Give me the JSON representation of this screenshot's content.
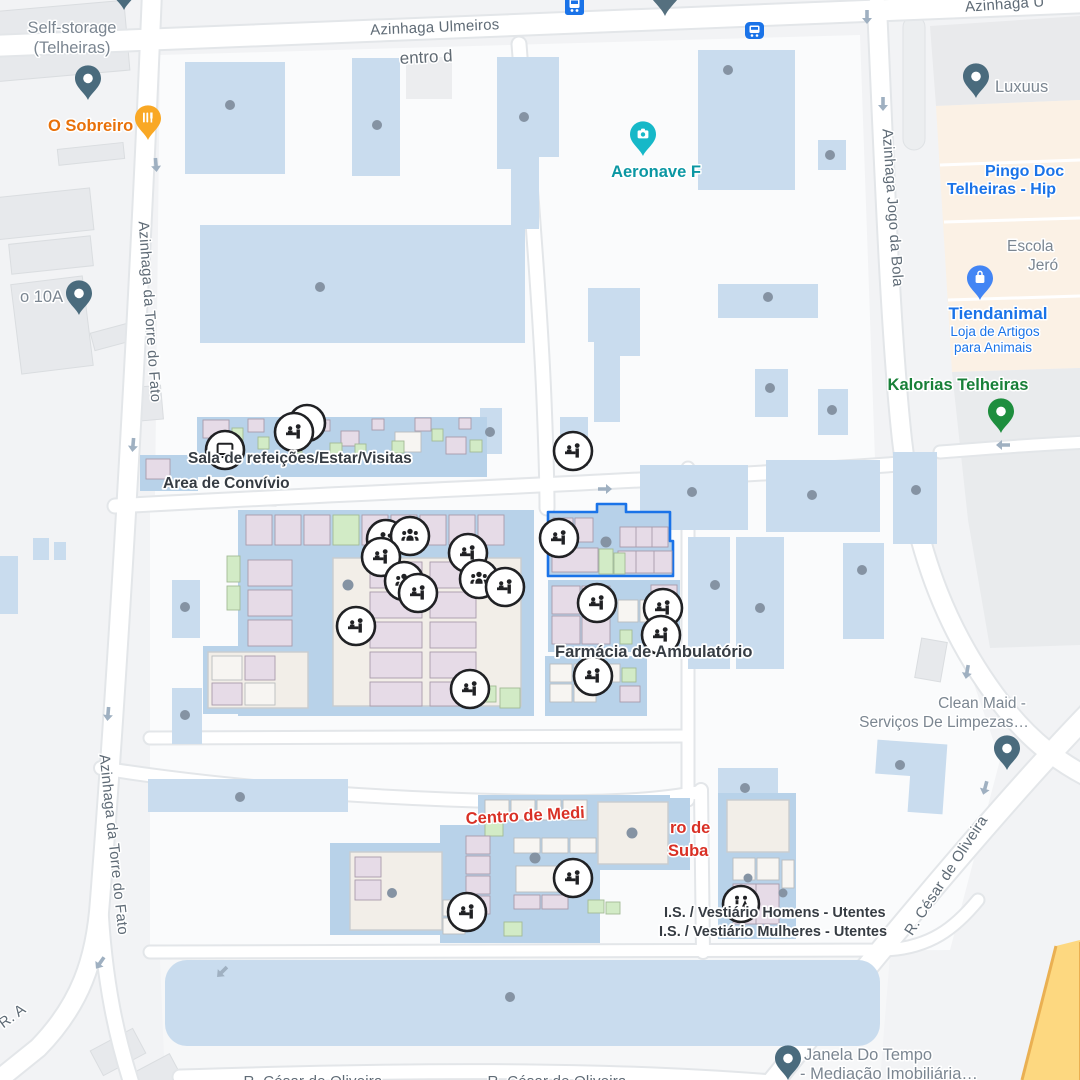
{
  "streets": {
    "ulmeiros": "Azinhaga Ulmeiros",
    "torre": "Azinhaga da Torre do Fato",
    "jogo": "Azinhaga Jogo da Bola",
    "cesar": "R. César de Oliveira",
    "ra": "R. A",
    "top_right_partial": "Azinhaga U",
    "centro_partial": "entro d"
  },
  "pois": {
    "self_storage": {
      "line1": "Self-storage",
      "line2": "(Telheiras)"
    },
    "o_sobreiro": {
      "label": "O Sobreiro"
    },
    "aeronave": {
      "label": "Aeronave F"
    },
    "luxuus": {
      "label": "Luxuus"
    },
    "pingo_doce": {
      "line1": "Pingo Doc",
      "line2": "Telheiras - Hip"
    },
    "escola": {
      "line1": "Escola",
      "line2": "Jeró"
    },
    "tiendanimal": {
      "label": "Tiendanimal",
      "sub1": "Loja de Artigos",
      "sub2": "para Animais"
    },
    "kalorias": {
      "label": "Kalorias Telheiras"
    },
    "ponto_10a": {
      "label": "o 10A"
    },
    "clean_maid": {
      "line1": "Clean Maid -",
      "line2": "Serviços De Limpezas…"
    },
    "janela": {
      "line1": "Janela Do Tempo",
      "line2": "- Mediação Imobiliária…"
    },
    "sala": {
      "label": "Sala de refeições/Estar/Visitas"
    },
    "convivio": {
      "label": "Area de Convívio"
    },
    "farmacia": {
      "label": "Farmácia de Ambulatório"
    },
    "is_homens": {
      "label": "I.S. / Vestiário Homens - Utentes"
    },
    "is_mulheres": {
      "label": "I.S. / Vestiário Mulheres - Utentes"
    },
    "centro_medicina": {
      "label": "Centro de Medi"
    },
    "red_partial_1": {
      "label": "ro de"
    },
    "red_partial_2": {
      "label": "Suba"
    }
  },
  "colors": {
    "poi_blue": "#1a73e8",
    "poi_green": "#188038",
    "poi_orange": "#e8710a",
    "poi_teal": "#0b97a3",
    "poi_red": "#d93025",
    "building_blue": "#c9dcee",
    "road_yellow": "#fdd880",
    "pin_slate": "#4a6b7d",
    "transit_blue": "#1a73e8"
  },
  "icons": {
    "reception": "reception-desk-icon",
    "group": "meeting-group-icon",
    "pair": "people-pair-icon",
    "tv": "tv-room-icon",
    "restroom": "restroom-icon",
    "bus": "bus-station-icon",
    "camera": "camera-attraction-icon",
    "bag": "shopping-bag-icon",
    "restaurant": "restaurant-icon",
    "pin": "map-pin-icon",
    "arrow": "one-way-arrow-icon"
  }
}
